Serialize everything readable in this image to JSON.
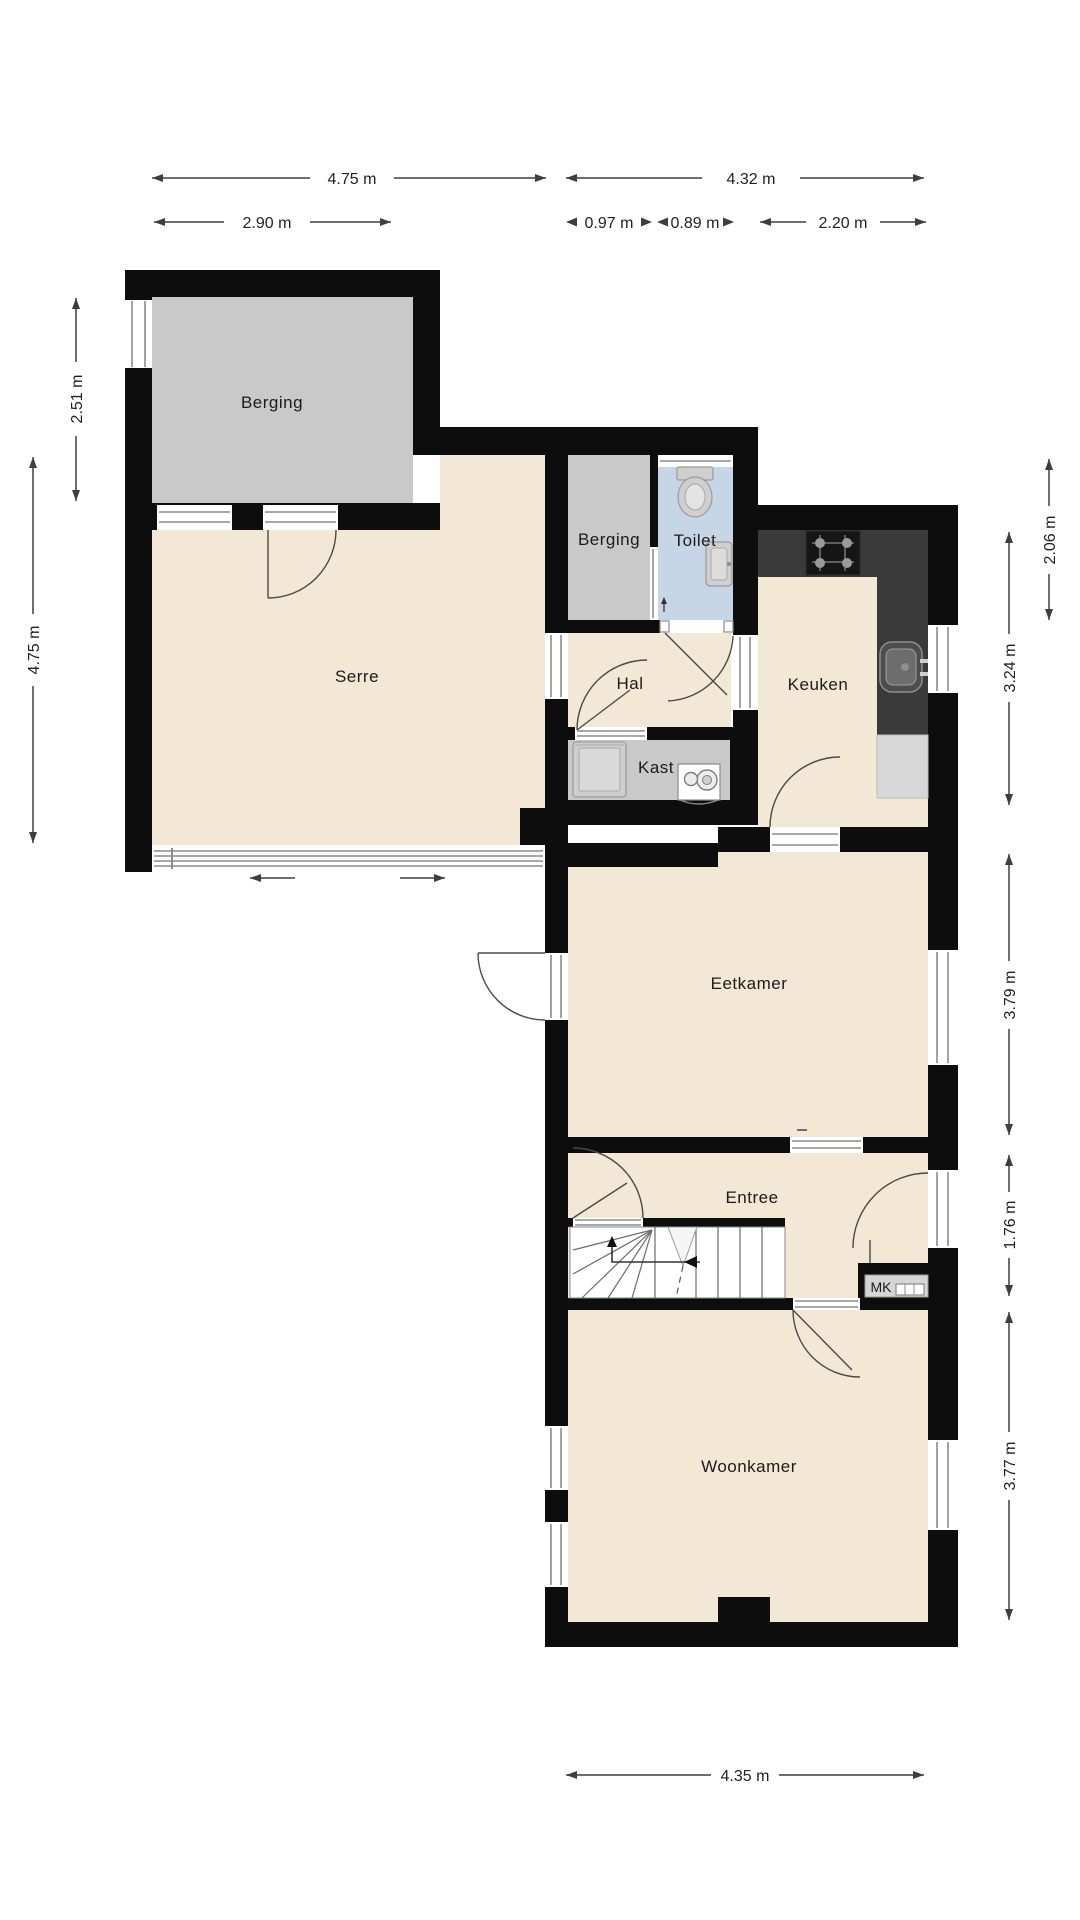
{
  "plan": {
    "rooms": {
      "berging_top": "Berging",
      "serre": "Serre",
      "berging_mid": "Berging",
      "toilet": "Toilet",
      "hal": "Hal",
      "keuken": "Keuken",
      "kast": "Kast",
      "eetkamer": "Eetkamer",
      "entree": "Entree",
      "mk": "MK",
      "woonkamer": "Woonkamer"
    },
    "dimensions": {
      "top": {
        "w_serre": "4.75 m",
        "w_right_wing": "4.32 m",
        "w_berging": "2.90 m",
        "w_berging2": "0.97 m",
        "w_toilet": "0.89 m",
        "w_keuken": "2.20 m"
      },
      "left": {
        "h_berging": "2.51 m",
        "h_serre": "4.75 m"
      },
      "right": {
        "h_top": "2.06 m",
        "h_keuken": "3.24 m",
        "h_eetkamer": "3.79 m",
        "h_entree": "1.76 m",
        "h_woonkamer": "3.77 m"
      },
      "bottom": {
        "w_woonkamer": "4.35 m"
      }
    },
    "colors": {
      "wall": "#0d0d0d",
      "floor": "#f2e8d5",
      "storage": "#c9c9c9",
      "toilet": "#c7d6e7",
      "counter": "#3a3a3a",
      "dim_line": "#3e3e3e"
    }
  }
}
